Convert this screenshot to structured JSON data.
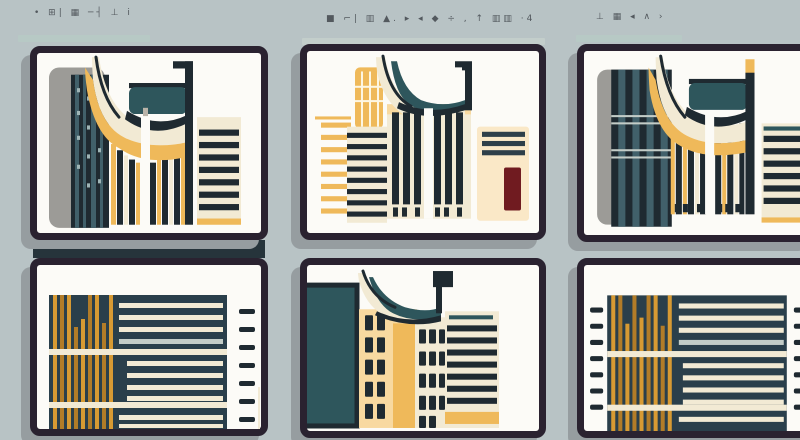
{
  "app": {
    "description": "Three-column gallery of six flat-style architecture illustration thumbnails"
  },
  "headers": {
    "left": {
      "pseudo_text": "• ⊞| ▦ ─┤ ⊥ i"
    },
    "middle": {
      "pseudo_text": "■ ⌐| ▥ ▲. ▸ ◂ ◆ ÷ , ↑ ▥▥ ·4"
    },
    "right": {
      "pseudo_text": "⊥ ▦ ◂ ∧ ›"
    }
  },
  "palette": {
    "background": "#b8c3c5",
    "card_background": "#fcfbf7",
    "card_border": "#2a2230",
    "shadow_gray": "#969da0",
    "ink_dark_teal": "#1f2a31",
    "teal": "#2e565c",
    "navy_panel": "#2a3f4b",
    "gold": "#d79a33",
    "gold_light": "#efb95a",
    "cream": "#f2ead4",
    "dark_red": "#701b20",
    "gray_slab": "#9c9b97",
    "accent_bar": "#b7c9c5",
    "stand_bar": "#26343b"
  },
  "cards": [
    {
      "id": "top-left",
      "alt": "Curved-roof hall with striped tower, gray slab and striped block building"
    },
    {
      "id": "top-middle",
      "alt": "Curved-roof hall with gold tower, striped building and red sign panel"
    },
    {
      "id": "top-right",
      "alt": "Curved-roof hall with mullioned dark tower and striped block building"
    },
    {
      "id": "bottom-left",
      "alt": "Dark panel with gold bars, cream text lines and dash list"
    },
    {
      "id": "bottom-middle",
      "alt": "Curved-roof facade with window grid, door panel and striped block"
    },
    {
      "id": "bottom-right",
      "alt": "Dark panel with gold bars, cream text lines and dash lists"
    }
  ]
}
